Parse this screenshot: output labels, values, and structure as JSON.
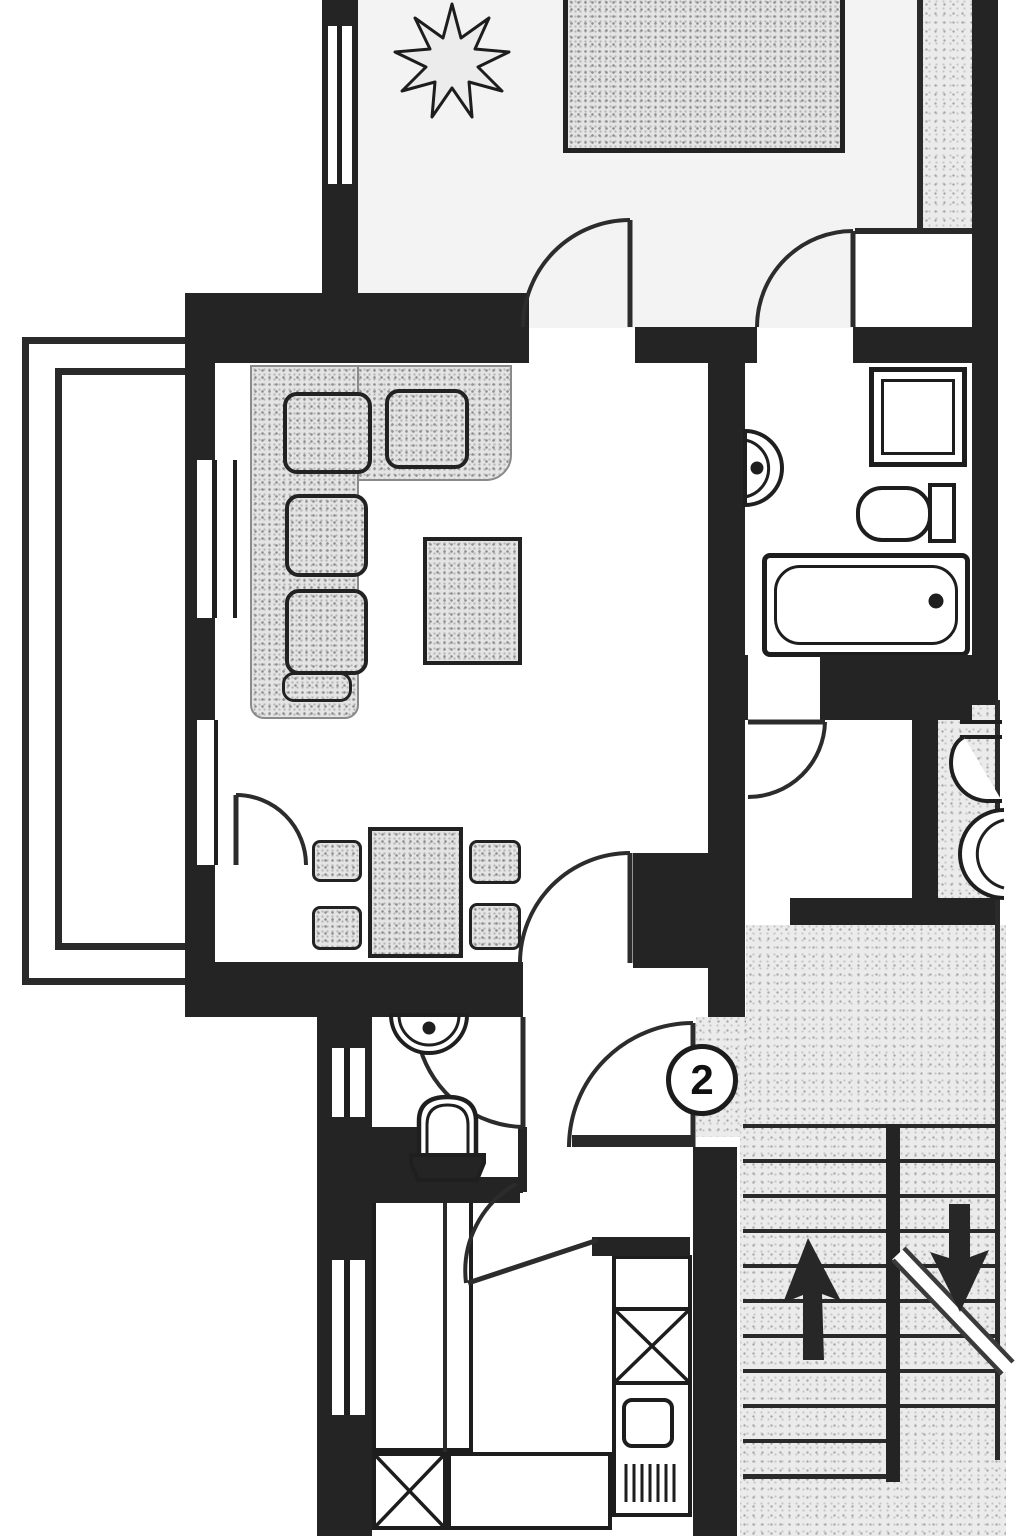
{
  "plan": {
    "unit_label": "2",
    "colors": {
      "wall": "#242424",
      "line": "#2c2c2c",
      "stipple_background": "#ebebeb",
      "floor": "#ffffff",
      "furniture_fill": "#e4e4e4"
    },
    "icons": {
      "stairs_up": "arrow-up-icon",
      "stairs_down": "arrow-down-icon",
      "plant": "plant-icon"
    }
  }
}
